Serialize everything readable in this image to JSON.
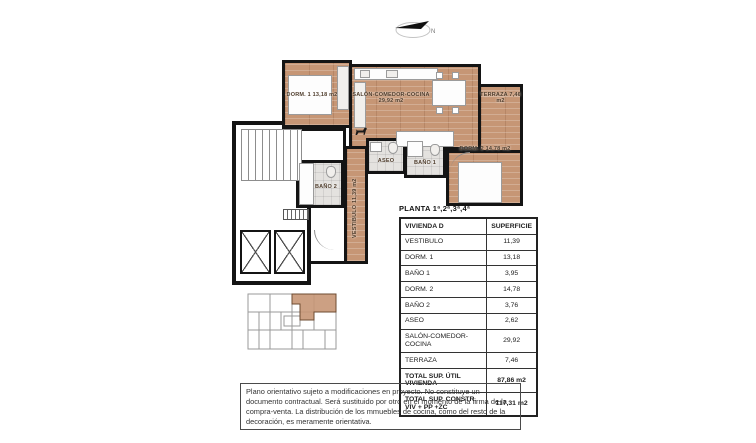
{
  "plan": {
    "north_label": "N",
    "labels": {
      "dorm1": "DORM. 1  13,18 m2",
      "salon": "SALÓN-COMEDOR-COCINA  29,92 m2",
      "terraza": "TERRAZA  7,46 m2",
      "dorm2": "DORM. 2  14,78 m2",
      "bano1": "BAÑO 1",
      "aseo": "ASEO",
      "bano2": "BAÑO 2",
      "vestibulo": "VESTIBULO  11,39 m2"
    }
  },
  "table": {
    "title": "PLANTA 1ª,2ª,3ª,4ª",
    "columns": [
      "VIVIENDA D",
      "SUPERFICIE"
    ],
    "rows": [
      [
        "VESTIBULO",
        "11,39"
      ],
      [
        "DORM. 1",
        "13,18"
      ],
      [
        "BAÑO 1",
        "3,95"
      ],
      [
        "DORM. 2",
        "14,78"
      ],
      [
        "BAÑO 2",
        "3,76"
      ],
      [
        "ASEO",
        "2,62"
      ],
      [
        "SALÓN-COMEDOR-COCINA",
        "29,92"
      ],
      [
        "TERRAZA",
        "7,46"
      ]
    ],
    "totals": [
      [
        "TOTAL SUP. ÚTIL VIVIENDA",
        "87,86 m2"
      ],
      [
        "TOTAL SUP. CONSTR. VIV + PP +ZC",
        "117,31 m2"
      ]
    ]
  },
  "disclaimer": "Plano orientativo sujeto a modificaciones en proyecto. No constituye un documento contractual. Será sustituido por otro en el momento de la firma de la compra-venta. La distribución de los mmuebles de cocina, como del resto de la decoración, es meramente orientativa.",
  "colors": {
    "wall": "#141414",
    "wood_floor": "#c69675",
    "tile_floor": "#e4e2df",
    "keyplan_highlight": "#c69675"
  }
}
